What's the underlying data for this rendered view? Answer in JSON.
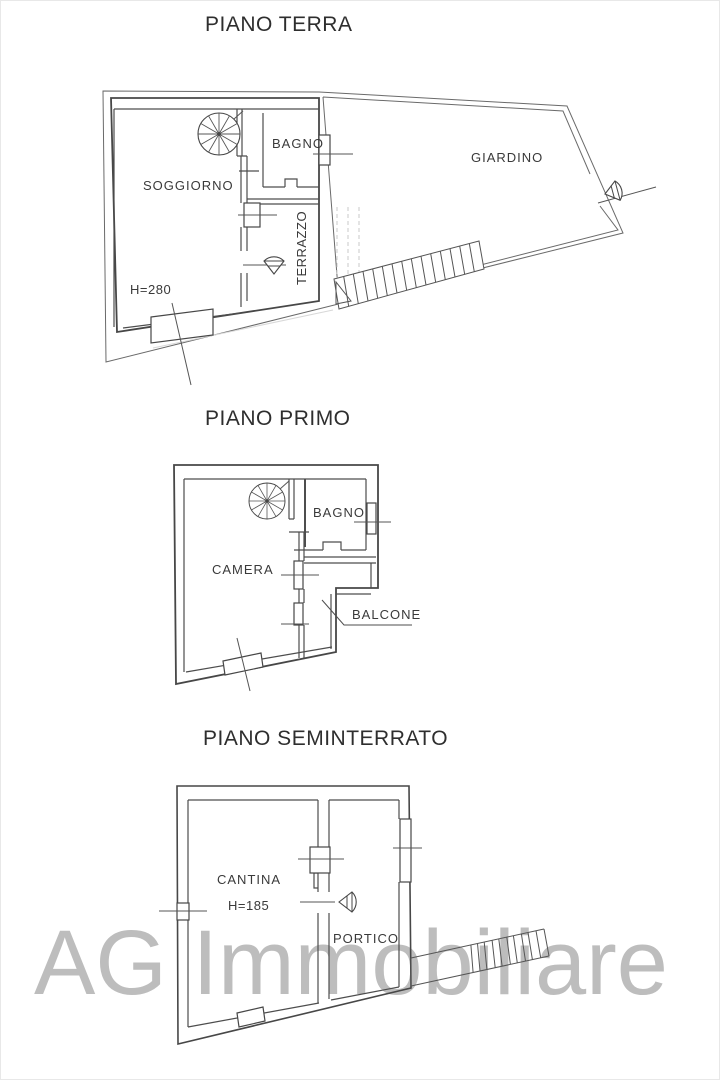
{
  "watermark": "AG Immobiliare",
  "colors": {
    "wall_line": "#474747",
    "thin_line": "#6a6a6a",
    "dashed_line": "#c9c9c9",
    "label_text": "#3a3a3a",
    "watermark_gray": "#bdbdbd",
    "background": "#ffffff"
  },
  "ground": {
    "title": "PIANO TERRA",
    "soggiorno": "SOGGIORNO",
    "bagno": "BAGNO",
    "terrazzo": "TERRAZZO",
    "giardino": "GIARDINO",
    "height": "H=280"
  },
  "first": {
    "title": "PIANO PRIMO",
    "camera": "CAMERA",
    "bagno": "BAGNO",
    "balcone": "BALCONE"
  },
  "basement": {
    "title": "PIANO SEMINTERRATO",
    "cantina": "CANTINA",
    "portico": "PORTICO",
    "height": "H=185"
  }
}
